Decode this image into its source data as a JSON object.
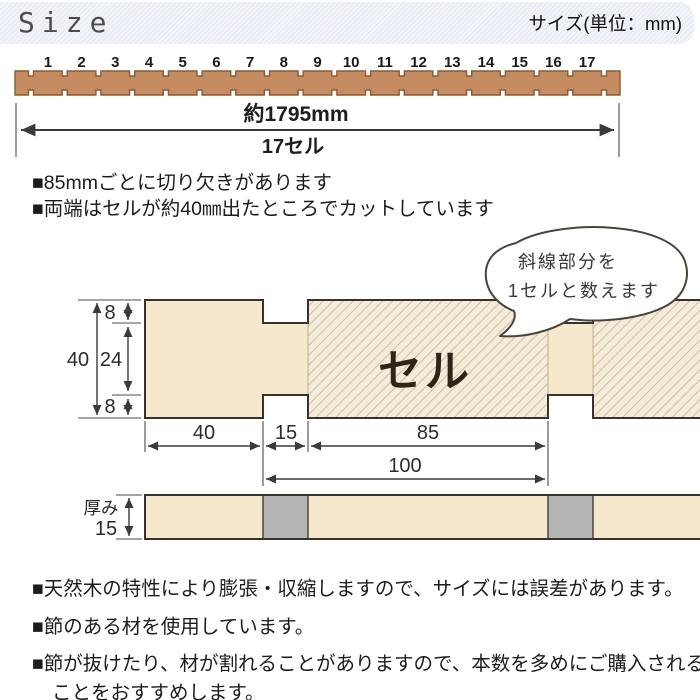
{
  "header": {
    "title": "Size",
    "subtitle": "サイズ(単位：mm)"
  },
  "ruler": {
    "cell_numbers": [
      "1",
      "2",
      "3",
      "4",
      "5",
      "6",
      "7",
      "8",
      "9",
      "10",
      "11",
      "12",
      "13",
      "14",
      "15",
      "16",
      "17"
    ],
    "length_label": "約1795mm",
    "cell_count_label": "17セル"
  },
  "notes_top": [
    "■85mmごとに切り欠きがあります",
    "■両端はセルが約40㎜出たところでカットしています"
  ],
  "cross_section": {
    "cell_label": "セル",
    "bubble": {
      "line1": "斜線部分を",
      "line2": "1セルと数えます"
    },
    "dim_total_height": "40",
    "dim_notch_depth_top": "8",
    "dim_middle_height": "24",
    "dim_notch_depth_bottom": "8",
    "dim_end_length": "40",
    "dim_notch_width": "15",
    "dim_cell_width": "85",
    "dim_pitch": "100"
  },
  "side_view": {
    "label": "厚み",
    "thickness": "15"
  },
  "notes_bottom": [
    "■天然木の特性により膨張・収縮しますので、サイズには誤差があります。",
    "■節のある材を使用しています。",
    "■節が抜けたり、材が割れることがありますので、本数を多めにご購入されることをおすすめします。"
  ],
  "colors": {
    "header_bg": "#e8edf4",
    "wood": "#c58c61",
    "wood_border": "#8c5a33",
    "cream": "#f5e8cc",
    "hatch_bg": "#f4ecdb",
    "hatch_line": "#ccb58e",
    "gray_block": "#b3b6b5",
    "outline": "#39322a"
  }
}
